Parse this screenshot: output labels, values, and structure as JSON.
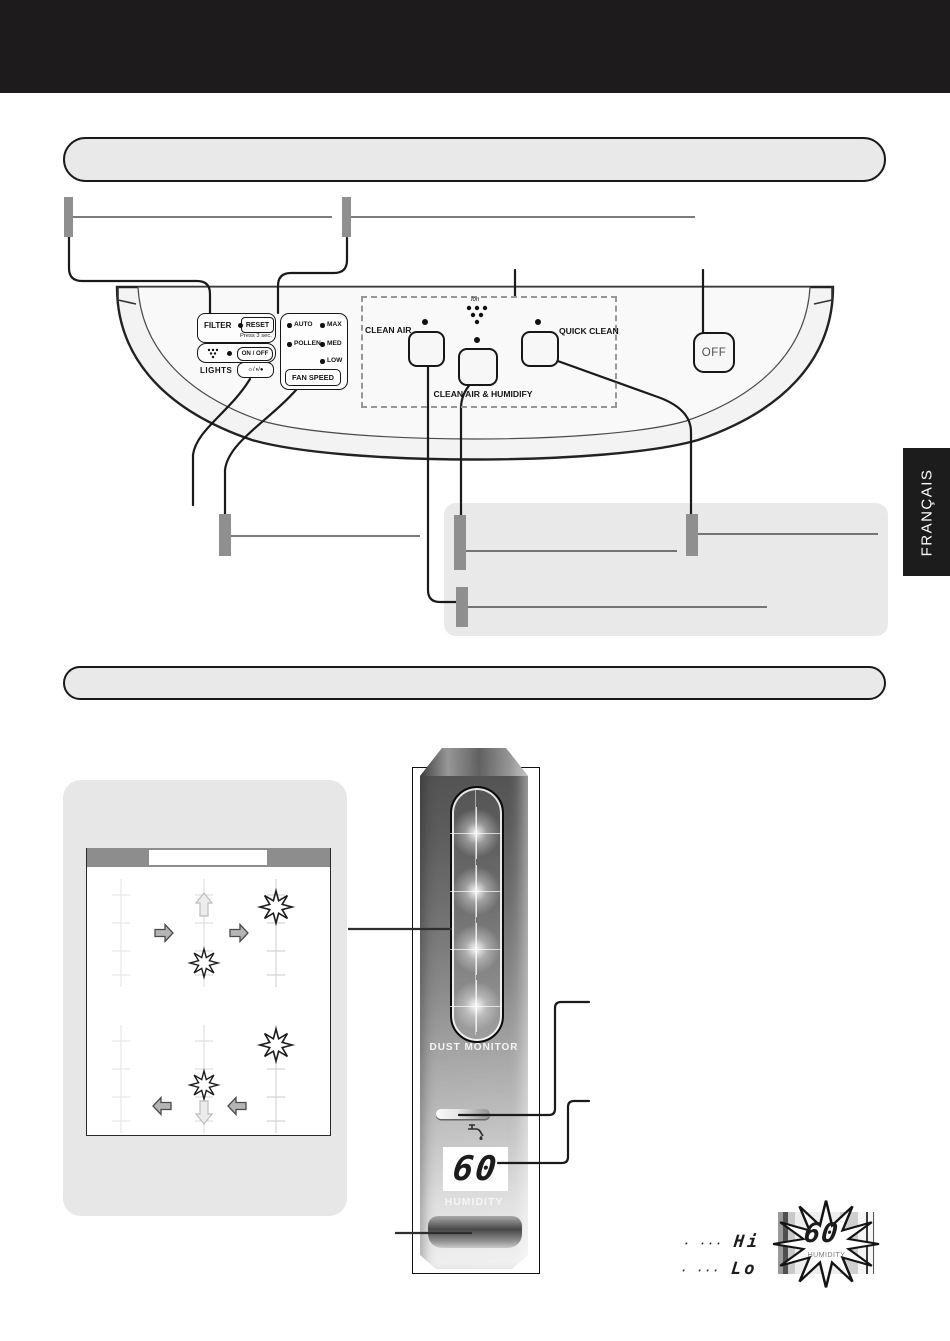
{
  "language_tab": {
    "label": "FRANÇAIS"
  },
  "control_panel": {
    "filter_label": "FILTER",
    "reset_button": "RESET",
    "reset_note": "Press 3 sec.",
    "on_off_button": "ON / OFF",
    "lights_label": "LIGHTS",
    "lights_button_glyphs": "☼/◑/●",
    "fan_speed": {
      "indicators": [
        "AUTO",
        "MAX",
        "POLLEN",
        "MED",
        "LOW"
      ],
      "button": "FAN SPEED"
    },
    "modes": {
      "clean_air_label": "CLEAN AIR",
      "ion_icon_label": "Ion",
      "clean_air_humidify_label": "CLEAN AIR & HUMIDIFY",
      "quick_clean_label": "QUICK CLEAN"
    },
    "off_button": "OFF"
  },
  "front_monitor": {
    "dust_monitor_label": "DUST MONITOR",
    "humidity_value": "60",
    "humidity_label": "HUMIDITY"
  },
  "legend": {
    "hi_prefix": "· ···",
    "hi": "Hi",
    "lo_prefix": "· ···",
    "lo": "Lo",
    "flash_value": "60",
    "flash_label": "HUMIDITY"
  }
}
